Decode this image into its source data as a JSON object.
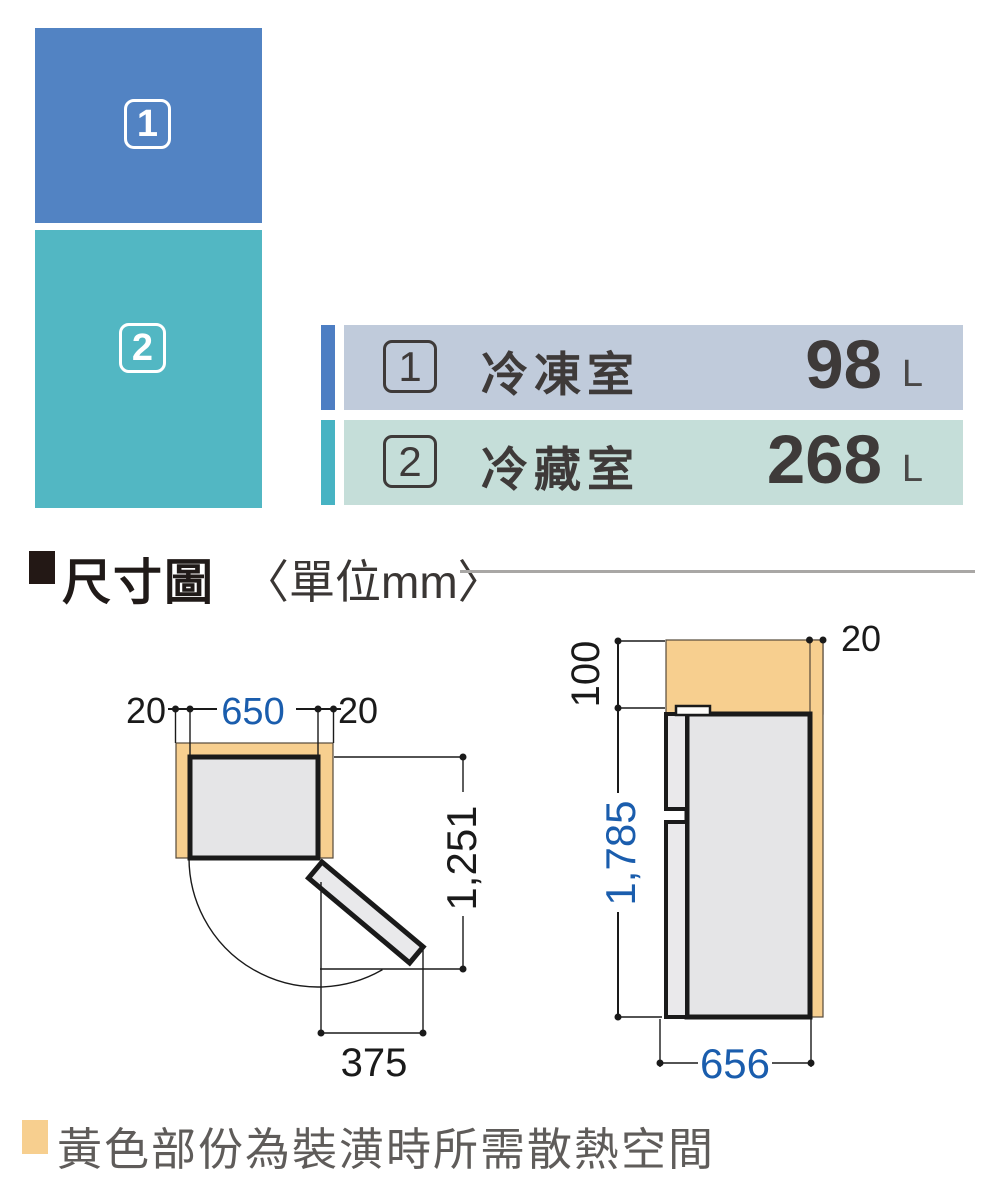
{
  "colors": {
    "freezer_block_blue": "#5283c3",
    "fridge_block_teal": "#52b7c3",
    "legend_blue_bar": "#4d7ec3",
    "legend_teal_bar": "#47b3c3",
    "legend_row1_bg": "#c0cbdb",
    "legend_row2_bg": "#c5ded9",
    "clearance_yellow": "#f7cf8f",
    "body_gray": "#e5e5e7",
    "dimension_blue": "#1a5dad",
    "line_black": "#1a1a1a"
  },
  "compartments": [
    {
      "num": "1",
      "label": "冷凍室",
      "value": "98",
      "unit": "L"
    },
    {
      "num": "2",
      "label": "冷藏室",
      "value": "268",
      "unit": "L"
    }
  ],
  "section_header": {
    "title": "尺寸圖",
    "unit_note": "〈單位mm〉"
  },
  "dimensions": {
    "top_view": {
      "left_clearance": "20",
      "width": "650",
      "right_clearance": "20",
      "depth_door_open": "1,251",
      "door_swing": "375"
    },
    "side_view": {
      "top_clearance": "100",
      "rear_clearance": "20",
      "height": "1,785",
      "depth": "656"
    }
  },
  "footnote": {
    "text": "黃色部份為裝潢時所需散熱空間"
  }
}
